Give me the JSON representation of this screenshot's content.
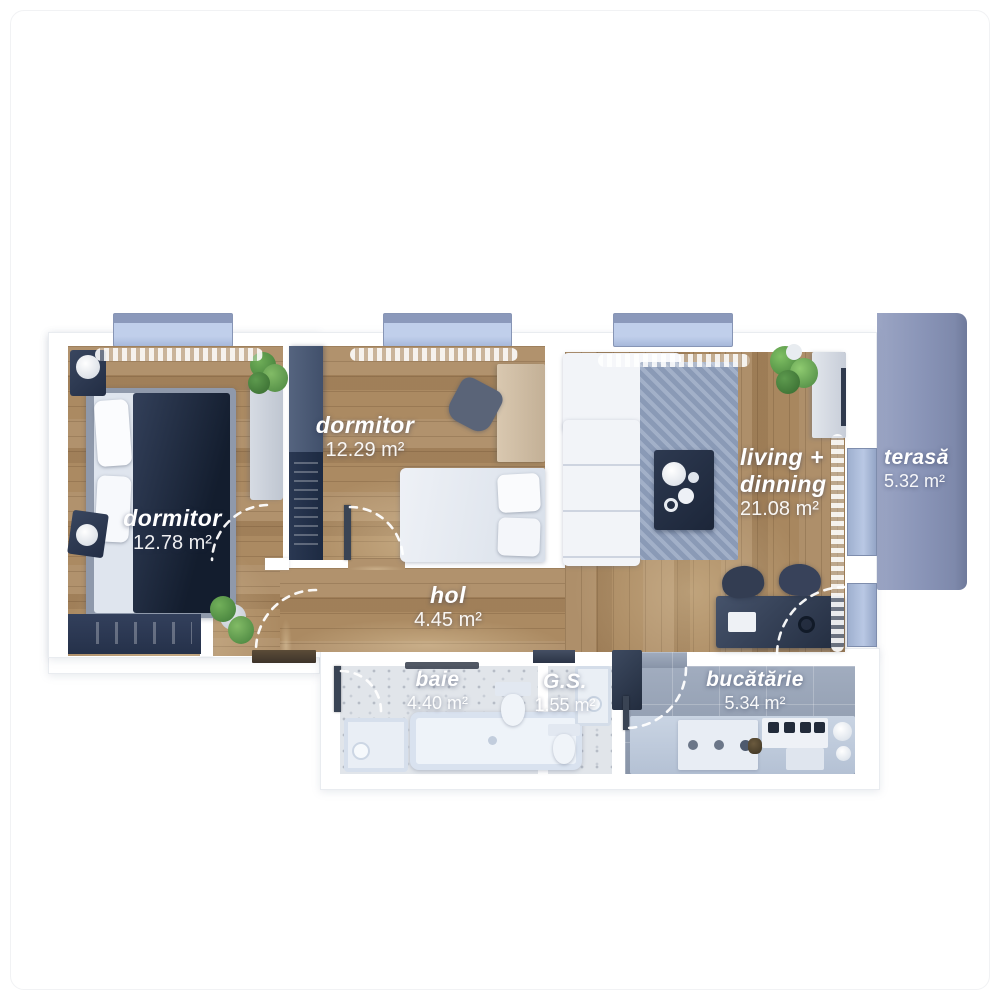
{
  "plan_title": "apartment-floor-plan",
  "rooms": {
    "dormitor1": {
      "name": "dormitor",
      "area": "12.78 m²"
    },
    "dormitor2": {
      "name": "dormitor",
      "area": "12.29 m²"
    },
    "hol": {
      "name": "hol",
      "area": "4.45 m²"
    },
    "living": {
      "name_line1": "living +",
      "name_line2": "dinning",
      "area": "21.08 m²"
    },
    "terasa": {
      "name": "terasă",
      "area": "5.32 m²"
    },
    "baie": {
      "name": "baie",
      "area": "4.40 m²"
    },
    "gs": {
      "name": "G.S.",
      "area": "1.55 m²"
    },
    "bucatarie": {
      "name": "bucătărie",
      "area": "5.34 m²"
    }
  },
  "colors": {
    "wood_floor": "#ab8a62",
    "terrace": "#8c96b8",
    "bath_tile": "#e1e5ea",
    "kitchen_tile": "#94a1b6",
    "furniture_navy": "#2e3c56",
    "label_text": "#ffffff"
  }
}
